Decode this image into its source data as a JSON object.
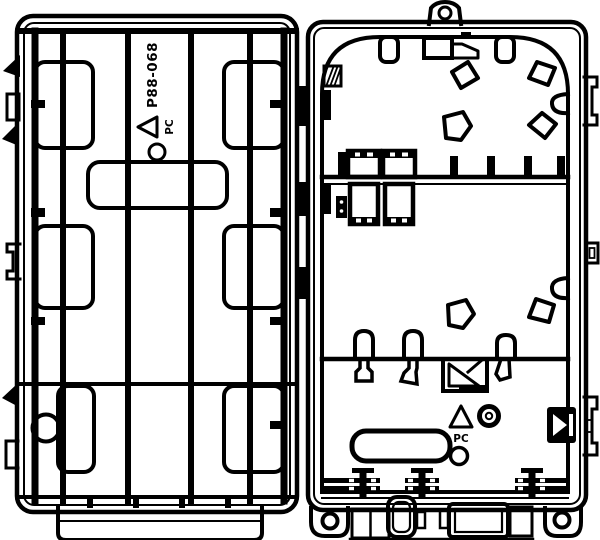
{
  "drawing": {
    "type": "technical-line-drawing",
    "subject": "fiber termination box opened: lid interior (left) and base interior (right)",
    "background_color": "#ffffff",
    "line_color": "#000000",
    "lid": {
      "part_number": "P88-068",
      "material_code": "PC",
      "recycle_icon": "recycling-triangle-icon"
    },
    "base": {
      "material_code": "PC",
      "recycle_icon": "recycling-triangle-icon"
    }
  }
}
